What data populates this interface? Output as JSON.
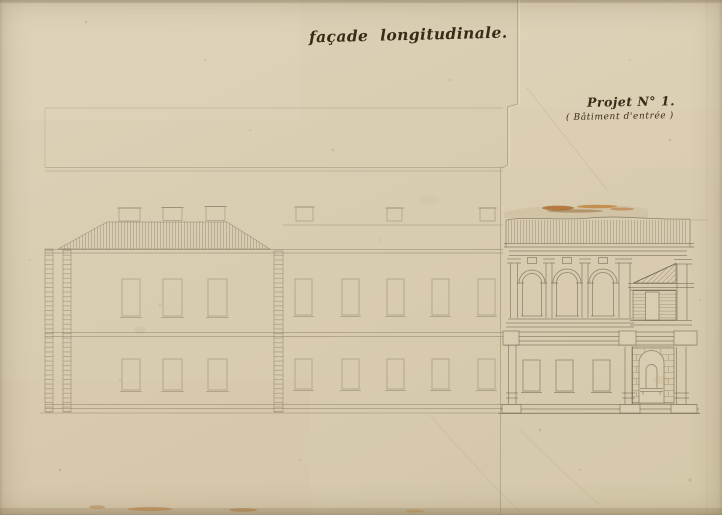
{
  "document": {
    "title": "façade longitudinale.",
    "project_label": "Projet N° 1.",
    "project_subtitle": "( Bâtiment d'entrée )"
  },
  "colors": {
    "paper": "#d9cdb1",
    "paper_light": "#e2d7bd",
    "paper_dark": "#c9ba9b",
    "ink": "#3a2b18",
    "pencil": "#6e624c",
    "tear": "#b26a24",
    "seam": "#a8987a"
  }
}
